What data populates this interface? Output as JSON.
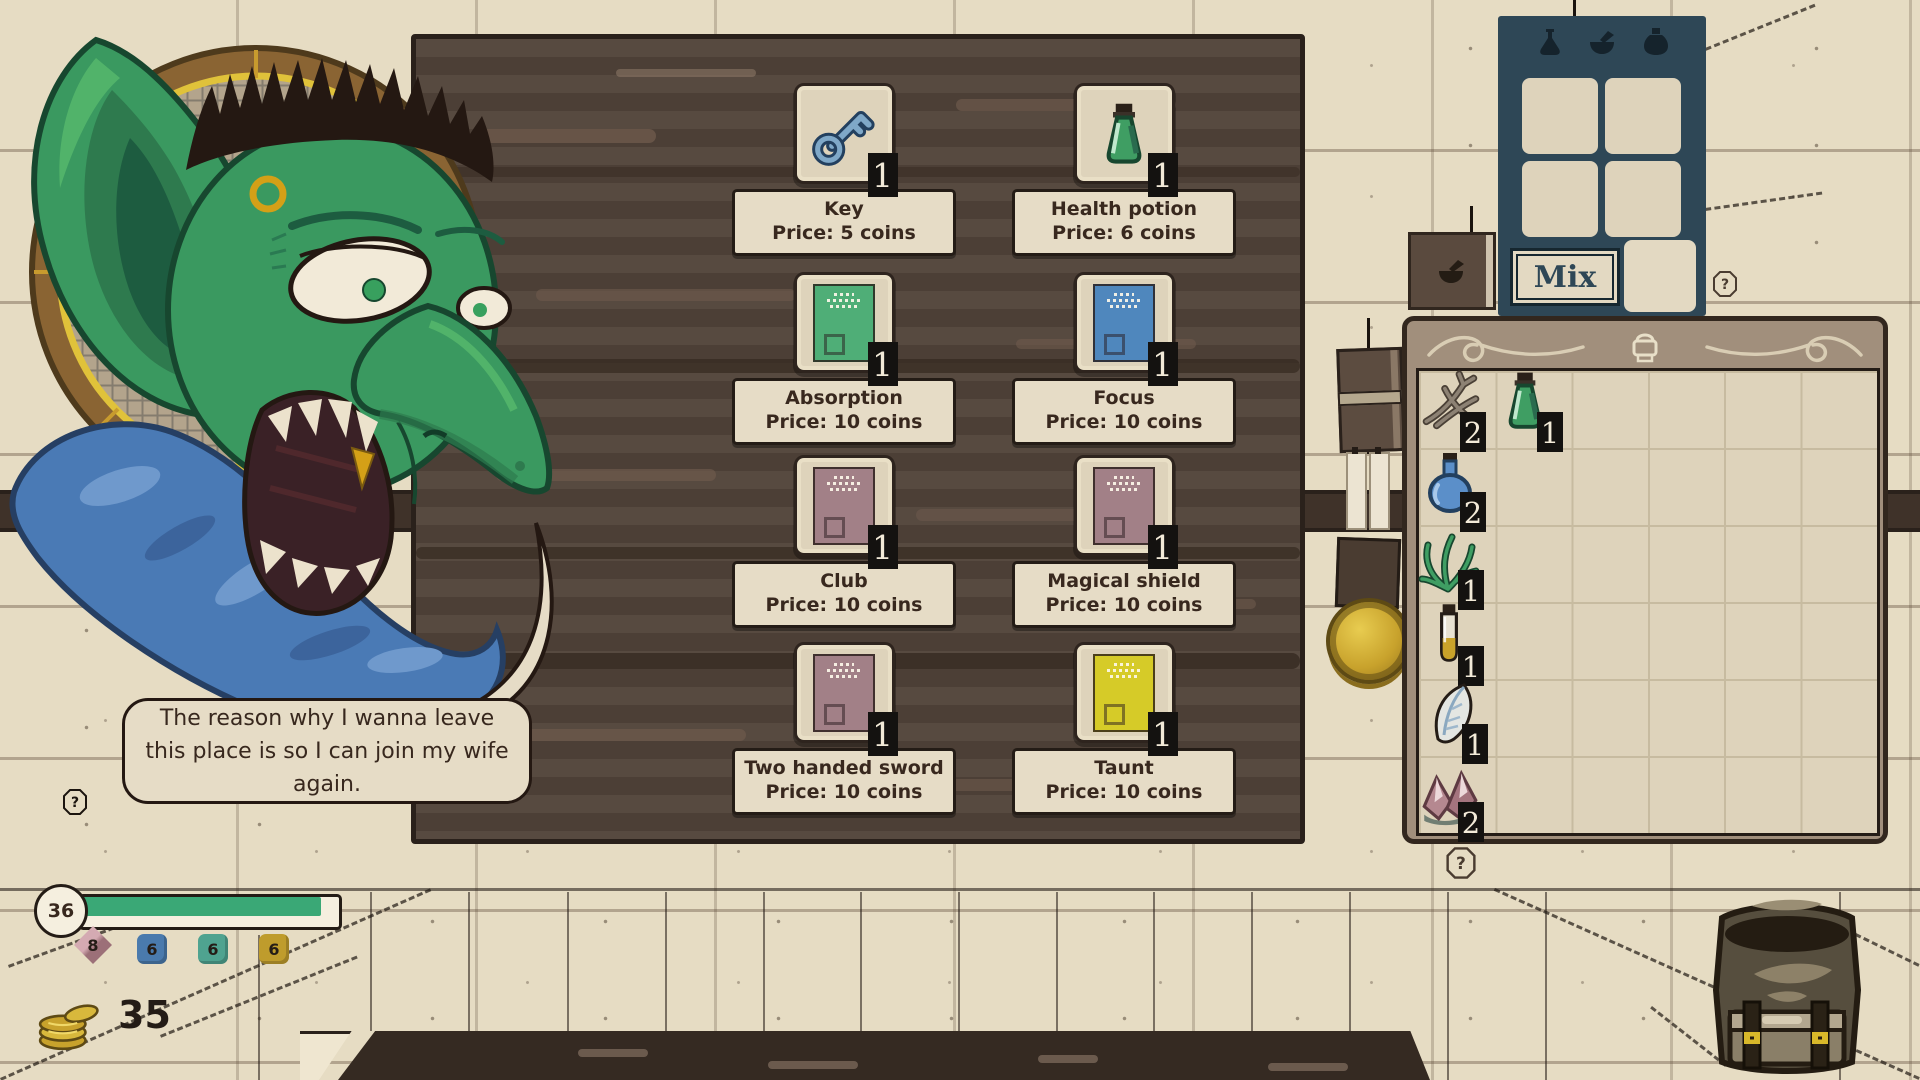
{
  "dialogue": {
    "text": "The reason why I wanna leave this place is so I can join my wife again."
  },
  "shop": {
    "help_label": "?",
    "items": [
      {
        "name": "Key",
        "price": "Price: 5 coins",
        "count": "1",
        "icon": "key-icon"
      },
      {
        "name": "Health potion",
        "price": "Price: 6 coins",
        "count": "1",
        "icon": "health-potion-icon"
      },
      {
        "name": "Absorption",
        "price": "Price: 10 coins",
        "count": "1",
        "icon": "scroll-card-icon",
        "card_color": "#4fae77"
      },
      {
        "name": "Focus",
        "price": "Price: 10 coins",
        "count": "1",
        "icon": "scroll-card-icon",
        "card_color": "#4f87bd"
      },
      {
        "name": "Club",
        "price": "Price: 10 coins",
        "count": "1",
        "icon": "scroll-card-icon",
        "card_color": "#a28087"
      },
      {
        "name": "Magical shield",
        "price": "Price: 10 coins",
        "count": "1",
        "icon": "scroll-card-icon",
        "card_color": "#a28087"
      },
      {
        "name": "Two handed sword",
        "price": "Price: 10 coins",
        "count": "1",
        "icon": "scroll-card-icon",
        "card_color": "#a28087"
      },
      {
        "name": "Taunt",
        "price": "Price: 10 coins",
        "count": "1",
        "icon": "scroll-card-icon",
        "card_color": "#d6cb28"
      }
    ]
  },
  "mixing": {
    "mix_label": "Mix",
    "help_label": "?",
    "header_icons": [
      "flask-icon",
      "mortar-pestle-icon",
      "bottle-icon"
    ],
    "panel_color": "#2e4756"
  },
  "inventory": {
    "help_label": "?",
    "header_icon": "backpack-icon",
    "items": [
      {
        "name": "dried root",
        "icon": "root-icon",
        "count": "2"
      },
      {
        "name": "health potion",
        "icon": "health-potion-icon",
        "count": "1"
      },
      {
        "name": "blue potion",
        "icon": "blue-potion-icon",
        "count": "2"
      },
      {
        "name": "herb",
        "icon": "herb-icon",
        "count": "1"
      },
      {
        "name": "oil vial",
        "icon": "vial-icon",
        "count": "1"
      },
      {
        "name": "feather vial",
        "icon": "feather-icon",
        "count": "1"
      },
      {
        "name": "pink crystals",
        "icon": "crystal-icon",
        "count": "2"
      }
    ]
  },
  "hud": {
    "health": {
      "value": "36",
      "fill_percent": "93%",
      "bar_color": "#3aa876"
    },
    "dice": [
      {
        "value": "8",
        "color": "#c0949c",
        "shape": "diamond"
      },
      {
        "value": "6",
        "color": "#4a7aad",
        "shape": "square"
      },
      {
        "value": "6",
        "color": "#4fa390",
        "shape": "square"
      },
      {
        "value": "6",
        "color": "#bf9c2c",
        "shape": "square"
      }
    ],
    "coins": "35",
    "coins_icon": "gold-coins-icon"
  },
  "colors": {
    "wall": "#e6dcc3",
    "shop_wood": "#52443a",
    "mix_panel": "#2e4756",
    "inventory_frame": "#a18f7c",
    "accent_gold": "#d8b82a",
    "health_green": "#3aa876"
  }
}
